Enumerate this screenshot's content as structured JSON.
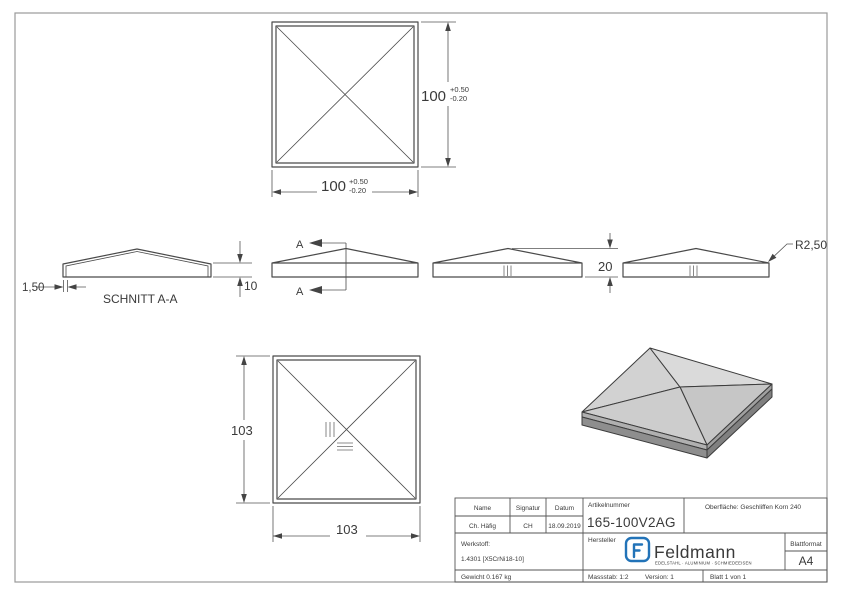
{
  "drawing": {
    "top_view": {
      "dim_height": "100",
      "dim_height_tol_plus": "+0.50",
      "dim_height_tol_minus": "-0.20",
      "dim_width": "100",
      "dim_width_tol_plus": "+0.50",
      "dim_width_tol_minus": "-0.20"
    },
    "section_view": {
      "label": "SCHNITT A-A",
      "dim_wall": "1,50",
      "dim_skirt": "10"
    },
    "front_view": {
      "section_letter": "A"
    },
    "side_view": {
      "dim_height": "20"
    },
    "radius_view": {
      "dim_radius": "R2,50"
    },
    "bottom_view": {
      "dim_width": "103",
      "dim_height": "103"
    }
  },
  "title_block": {
    "col_name": "Name",
    "col_signatur": "Signatur",
    "col_datum": "Datum",
    "name_value": "Ch. Häfig",
    "signatur_value": "CH",
    "datum_value": "18.09.2019",
    "artikelnummer_label": "Artikelnummer",
    "artikelnummer_value": "165-100V2AG",
    "oberflaeche": "Oberfläche:  Geschliffen Korn 240",
    "werkstoff_label": "Werkstoff:",
    "werkstoff_value": "1.4301 [X5CrNi18-10]",
    "hersteller_label": "Hersteller",
    "gewicht": "Gewicht 0.167 kg",
    "massstab": "Massstab: 1:2",
    "version": "Version: 1",
    "blatt": "Blatt 1 von 1",
    "blattformat_label": "Blattformat",
    "blattformat_value": "A4",
    "logo": {
      "brand": "Feldmann",
      "tagline": "EDELSTAHL · ALUMINIUM · SCHMIEDEEISEN",
      "color": "#2273b8"
    }
  }
}
